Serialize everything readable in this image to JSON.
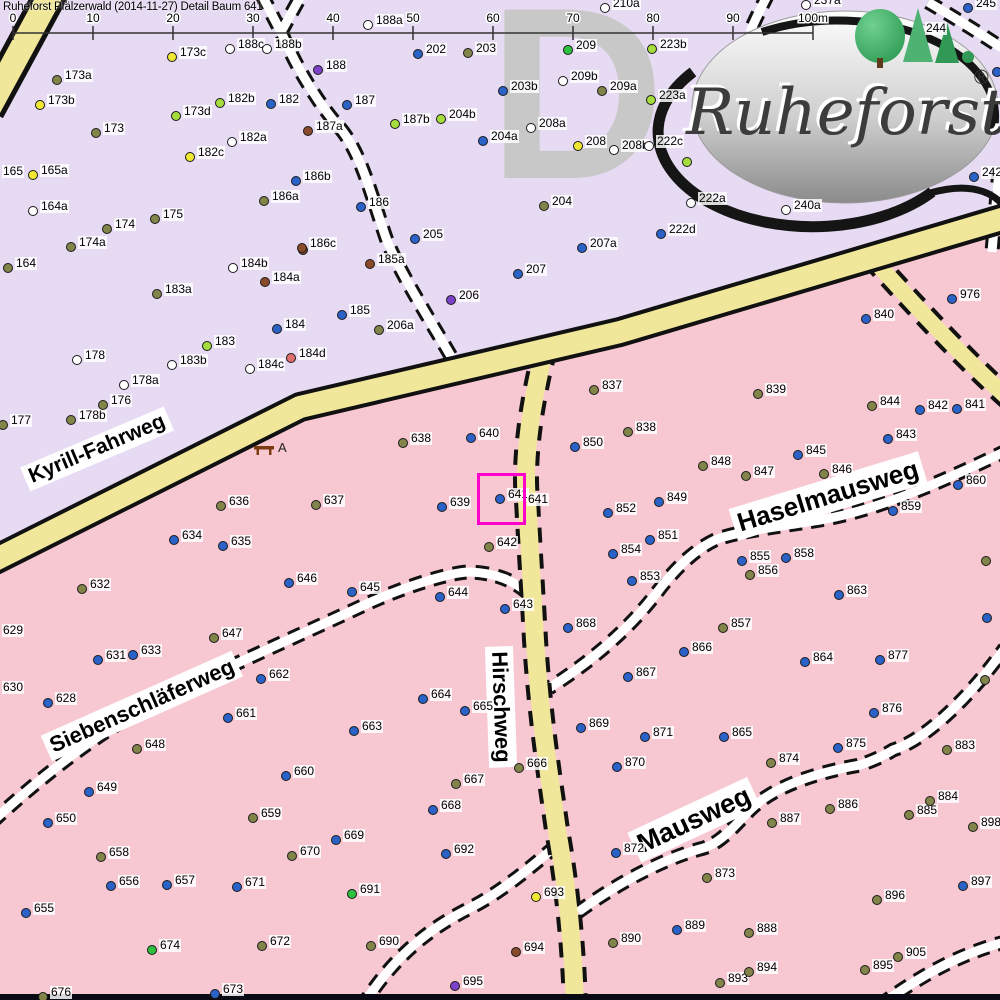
{
  "title": "Ruheforst Pfälzerwald (2014-11-27) Detail  Baum 641",
  "scale": {
    "ticks": [
      "0",
      "10",
      "20",
      "30",
      "40",
      "50",
      "60",
      "70",
      "80",
      "90",
      "100m"
    ]
  },
  "watermark": "D",
  "logo": {
    "text": "Ruheforst",
    "reg": "®"
  },
  "bench": {
    "label": "A"
  },
  "selection": {
    "tree": "641"
  },
  "roads": {
    "labels": [
      {
        "id": "kyrill",
        "text": "Kyrill-Fahrweg"
      },
      {
        "id": "siebenschlaeferweg",
        "text": "Siebenschläferweg"
      },
      {
        "id": "hirschweg",
        "text": "Hirschweg"
      },
      {
        "id": "haselmausweg",
        "text": "Haselmausweg"
      },
      {
        "id": "mausweg",
        "text": "Mausweg"
      }
    ]
  },
  "colors": {
    "lavender": "#e7daf3",
    "pink": "#f8c8d2",
    "road_yellow": "#f0e79b",
    "magenta": "#ff00cc",
    "blue": "#2a62c8",
    "olive": "#82844a",
    "yellow": "#f0e832",
    "light_green": "#a6dc3e",
    "green": "#2ec23e",
    "white": "#ffffff",
    "purple": "#7c42c8",
    "brown": "#8a4b2a",
    "red": "#e06e6e",
    "watermark_gray": "#c8c8c8"
  },
  "trees": [
    [
      "173c",
      172,
      57,
      "y"
    ],
    [
      "173a",
      57,
      80,
      "o"
    ],
    [
      "173b",
      40,
      105,
      "y"
    ],
    [
      "173",
      96,
      133,
      "o"
    ],
    [
      "173d",
      176,
      116,
      "lg"
    ],
    [
      "182b",
      220,
      103,
      "lg"
    ],
    [
      "182c",
      190,
      157,
      "y"
    ],
    [
      "182a",
      232,
      142,
      "w"
    ],
    [
      "165a",
      33,
      175,
      "y"
    ],
    [
      "165",
      2,
      165,
      ""
    ],
    [
      "164a",
      33,
      211,
      "w"
    ],
    [
      "164",
      8,
      268,
      "o"
    ],
    [
      "174",
      107,
      229,
      "o"
    ],
    [
      "175",
      155,
      219,
      "o"
    ],
    [
      "174a",
      71,
      247,
      "o"
    ],
    [
      "177",
      3,
      425,
      "o"
    ],
    [
      "178b",
      71,
      420,
      "o"
    ],
    [
      "176",
      103,
      405,
      "o"
    ],
    [
      "178a",
      124,
      385,
      "w"
    ],
    [
      "178",
      77,
      360,
      "w"
    ],
    [
      "183a",
      157,
      294,
      "o"
    ],
    [
      "183b",
      172,
      365,
      "w"
    ],
    [
      "183",
      207,
      346,
      "lg"
    ],
    [
      "184b",
      233,
      268,
      "w"
    ],
    [
      "184a",
      265,
      282,
      "br"
    ],
    [
      "",
      303,
      250,
      "br"
    ],
    [
      "185a",
      370,
      264,
      "br"
    ],
    [
      "185",
      342,
      315,
      "b"
    ],
    [
      "206a",
      379,
      330,
      "o"
    ],
    [
      "206",
      451,
      300,
      "p"
    ],
    [
      "184",
      277,
      329,
      "b"
    ],
    [
      "184d",
      291,
      358,
      "r"
    ],
    [
      "184c",
      250,
      369,
      "w"
    ],
    [
      "188c",
      230,
      49,
      "w"
    ],
    [
      "188b",
      267,
      49,
      "w"
    ],
    [
      "188a",
      368,
      25,
      "w"
    ],
    [
      "188",
      318,
      70,
      "p"
    ],
    [
      "202",
      418,
      54,
      "b"
    ],
    [
      "203",
      468,
      53,
      "o"
    ],
    [
      "182",
      271,
      104,
      "b"
    ],
    [
      "187",
      347,
      105,
      "b"
    ],
    [
      "187a",
      308,
      131,
      "br"
    ],
    [
      "187b",
      395,
      124,
      "lg"
    ],
    [
      "204b",
      441,
      119,
      "lg"
    ],
    [
      "204a",
      483,
      141,
      "b"
    ],
    [
      "186b",
      296,
      181,
      "b"
    ],
    [
      "186a",
      264,
      201,
      "o"
    ],
    [
      "186",
      361,
      207,
      "b"
    ],
    [
      "205",
      415,
      239,
      "b"
    ],
    [
      "186c",
      302,
      248,
      "br"
    ],
    [
      "203b",
      503,
      91,
      "b"
    ],
    [
      "209",
      568,
      50,
      "g"
    ],
    [
      "209b",
      563,
      81,
      "w"
    ],
    [
      "209a",
      602,
      91,
      "o"
    ],
    [
      "223b",
      652,
      49,
      "lg"
    ],
    [
      "223a",
      651,
      100,
      "lg"
    ],
    [
      "208a",
      531,
      128,
      "w"
    ],
    [
      "208",
      578,
      146,
      "y"
    ],
    [
      "208b",
      614,
      150,
      "w"
    ],
    [
      "222c",
      649,
      146,
      "w"
    ],
    [
      "",
      687,
      162,
      "lg"
    ],
    [
      "204",
      544,
      206,
      "o"
    ],
    [
      "210a",
      605,
      8,
      "w"
    ],
    [
      "237a",
      806,
      5,
      "w"
    ],
    [
      "245",
      968,
      8,
      "b"
    ],
    [
      "244",
      925,
      22,
      ""
    ],
    [
      "242",
      974,
      177,
      "b"
    ],
    [
      "",
      997,
      72,
      "b"
    ],
    [
      "240a",
      786,
      210,
      "w"
    ],
    [
      "222a",
      691,
      203,
      "w"
    ],
    [
      "222d",
      661,
      234,
      "b"
    ],
    [
      "207a",
      582,
      248,
      "b"
    ],
    [
      "207",
      518,
      274,
      "b"
    ],
    [
      "976",
      952,
      299,
      "b"
    ],
    [
      "840",
      866,
      319,
      "b"
    ],
    [
      "837",
      594,
      390,
      "o"
    ],
    [
      "838",
      628,
      432,
      "o"
    ],
    [
      "850",
      575,
      447,
      "b"
    ],
    [
      "848",
      703,
      466,
      "o"
    ],
    [
      "847",
      746,
      476,
      "o"
    ],
    [
      "849",
      659,
      502,
      "b"
    ],
    [
      "839",
      758,
      394,
      "o"
    ],
    [
      "844",
      872,
      406,
      "o"
    ],
    [
      "842",
      920,
      410,
      "b"
    ],
    [
      "841",
      957,
      409,
      "b"
    ],
    [
      "843",
      888,
      439,
      "b"
    ],
    [
      "845",
      798,
      455,
      "b"
    ],
    [
      "846",
      824,
      474,
      "o"
    ],
    [
      "860",
      958,
      485,
      "b"
    ],
    [
      "638",
      403,
      443,
      "o"
    ],
    [
      "640",
      471,
      438,
      "b"
    ],
    [
      "636",
      221,
      506,
      "o"
    ],
    [
      "637",
      316,
      505,
      "o"
    ],
    [
      "639",
      442,
      507,
      "b"
    ],
    [
      "641",
      500,
      499,
      "b"
    ],
    [
      "641",
      527,
      493,
      ""
    ],
    [
      "642",
      489,
      547,
      "o"
    ],
    [
      "634",
      174,
      540,
      "b"
    ],
    [
      "635",
      223,
      546,
      "b"
    ],
    [
      "632",
      82,
      589,
      "o"
    ],
    [
      "629",
      2,
      624,
      ""
    ],
    [
      "630",
      2,
      681,
      ""
    ],
    [
      "631",
      98,
      660,
      "b"
    ],
    [
      "633",
      133,
      655,
      "b"
    ],
    [
      "628",
      48,
      703,
      "b"
    ],
    [
      "647",
      214,
      638,
      "o"
    ],
    [
      "646",
      289,
      583,
      "b"
    ],
    [
      "645",
      352,
      592,
      "b"
    ],
    [
      "644",
      440,
      597,
      "b"
    ],
    [
      "643",
      505,
      609,
      "b"
    ],
    [
      "662",
      261,
      679,
      "b"
    ],
    [
      "661",
      228,
      718,
      "b"
    ],
    [
      "648",
      137,
      749,
      "o"
    ],
    [
      "663",
      354,
      731,
      "b"
    ],
    [
      "664",
      423,
      699,
      "b"
    ],
    [
      "665",
      465,
      711,
      "b"
    ],
    [
      "851",
      650,
      540,
      "b"
    ],
    [
      "852",
      608,
      513,
      "b"
    ],
    [
      "854",
      613,
      554,
      "b"
    ],
    [
      "853",
      632,
      581,
      "b"
    ],
    [
      "868",
      568,
      628,
      "b"
    ],
    [
      "866",
      684,
      652,
      "b"
    ],
    [
      "867",
      628,
      677,
      "b"
    ],
    [
      "857",
      723,
      628,
      "o"
    ],
    [
      "855",
      742,
      561,
      "b"
    ],
    [
      "856",
      750,
      575,
      "o"
    ],
    [
      "858",
      786,
      558,
      "b"
    ],
    [
      "859",
      893,
      511,
      "b"
    ],
    [
      "863",
      839,
      595,
      "b"
    ],
    [
      "864",
      805,
      662,
      "b"
    ],
    [
      "877",
      880,
      660,
      "b"
    ],
    [
      "876",
      874,
      713,
      "b"
    ],
    [
      "875",
      838,
      748,
      "b"
    ],
    [
      "883",
      947,
      750,
      "o"
    ],
    [
      "",
      986,
      561,
      "o"
    ],
    [
      "",
      987,
      618,
      "b"
    ],
    [
      "",
      985,
      680,
      "o"
    ],
    [
      "869",
      581,
      728,
      "b"
    ],
    [
      "871",
      645,
      737,
      "b"
    ],
    [
      "865",
      724,
      737,
      "b"
    ],
    [
      "649",
      89,
      792,
      "b"
    ],
    [
      "650",
      48,
      823,
      "b"
    ],
    [
      "658",
      101,
      857,
      "o"
    ],
    [
      "656",
      111,
      886,
      "b"
    ],
    [
      "657",
      167,
      885,
      "b"
    ],
    [
      "655",
      26,
      913,
      "b"
    ],
    [
      "674",
      152,
      950,
      "g"
    ],
    [
      "676",
      43,
      997,
      "o"
    ],
    [
      "673",
      215,
      994,
      "b"
    ],
    [
      "660",
      286,
      776,
      "b"
    ],
    [
      "659",
      253,
      818,
      "o"
    ],
    [
      "667",
      456,
      784,
      "o"
    ],
    [
      "668",
      433,
      810,
      "b"
    ],
    [
      "669",
      336,
      840,
      "b"
    ],
    [
      "670",
      292,
      856,
      "o"
    ],
    [
      "671",
      237,
      887,
      "b"
    ],
    [
      "692",
      446,
      854,
      "b"
    ],
    [
      "691",
      352,
      894,
      "g"
    ],
    [
      "672",
      262,
      946,
      "o"
    ],
    [
      "690",
      371,
      946,
      "o"
    ],
    [
      "695",
      455,
      986,
      "p"
    ],
    [
      "666",
      519,
      768,
      "o"
    ],
    [
      "870",
      617,
      767,
      "b"
    ],
    [
      "872",
      616,
      853,
      "b"
    ],
    [
      "873",
      707,
      878,
      "o"
    ],
    [
      "693",
      536,
      897,
      "y"
    ],
    [
      "694",
      516,
      952,
      "br"
    ],
    [
      "889",
      677,
      930,
      "b"
    ],
    [
      "890",
      613,
      943,
      "o"
    ],
    [
      "874",
      771,
      763,
      "o"
    ],
    [
      "886",
      830,
      809,
      "o"
    ],
    [
      "887",
      772,
      823,
      "o"
    ],
    [
      "885",
      909,
      815,
      "o"
    ],
    [
      "884",
      930,
      801,
      "o"
    ],
    [
      "898",
      973,
      827,
      "o"
    ],
    [
      "888",
      749,
      933,
      "o"
    ],
    [
      "896",
      877,
      900,
      "o"
    ],
    [
      "897",
      963,
      886,
      "b"
    ],
    [
      "893",
      720,
      983,
      "o"
    ],
    [
      "894",
      749,
      972,
      "o"
    ],
    [
      "895",
      865,
      970,
      "o"
    ],
    [
      "905",
      898,
      957,
      "o"
    ]
  ]
}
